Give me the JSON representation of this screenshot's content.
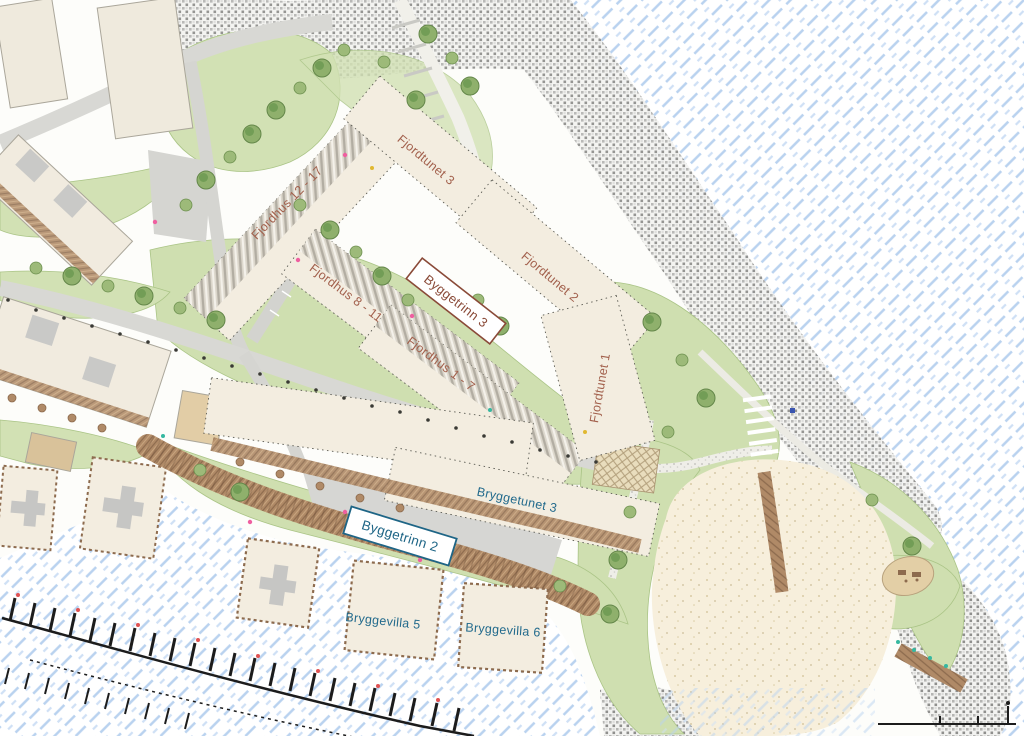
{
  "labels": {
    "fjordhus_12_17": "Fjordhus 12 - 17",
    "fjordtunet_3": "Fjordtunet 3",
    "byggetrinn_3": "Byggetrinn 3",
    "fjordhus_8_11": "Fjordhus 8 - 11",
    "fjordtunet_2": "Fjordtunet 2",
    "fjordhus_1_7": "Fjordhus 1 - 7",
    "fjordtunet_1": "Fjordtunet 1",
    "bryggetunet_3": "Bryggetunet 3",
    "byggetrinn_2": "Byggetrinn 2",
    "bryggevilla_5": "Bryggevilla 5",
    "bryggevilla_6": "Bryggevilla 6"
  },
  "colors": {
    "label_brown": "#a2604c",
    "label_blue": "#226a8c",
    "box_border_brown": "#8a4a38",
    "box_border_blue": "#1e6586",
    "water_dash_blue": "#b9d2ef",
    "green_area": "#d2e1b4",
    "tree_green": "#6d9a52",
    "building_cream": "#f3ede0",
    "road_grey": "#d8d8d4",
    "boardwalk_brown": "#b08a67",
    "sand_beige": "#f7efdc",
    "riprap_grey": "#bdbdbb",
    "marina_ink": "#1c1c1c"
  }
}
